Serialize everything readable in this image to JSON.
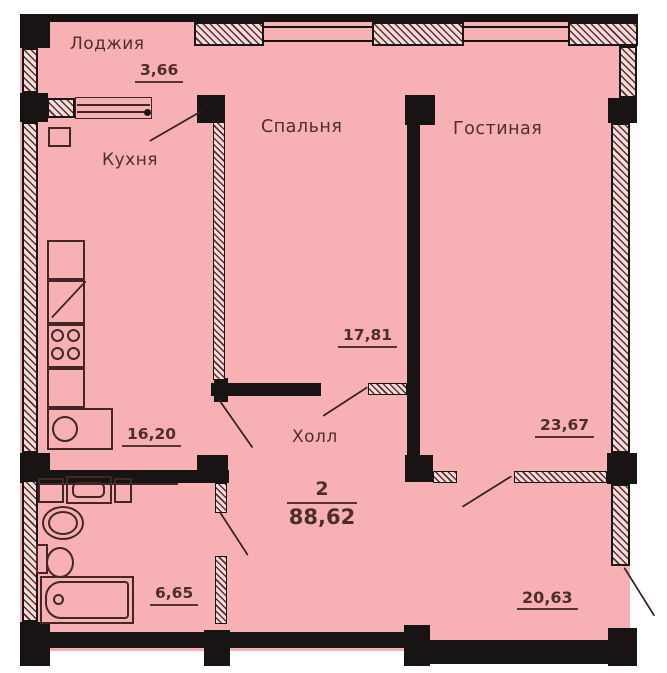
{
  "plan": {
    "summary": {
      "rooms_count": "2",
      "total_area": "88,62"
    },
    "rooms": [
      {
        "name": "Лоджия",
        "area": "3,66"
      },
      {
        "name": "Кухня",
        "area": "16,20"
      },
      {
        "name": "Спальня",
        "area": "17,81"
      },
      {
        "name": "Гостиная",
        "area": "23,67"
      },
      {
        "name": "Холл",
        "area": "20,63"
      },
      {
        "name": "",
        "area": "6,65"
      }
    ],
    "colors": {
      "room_fill": "#f7b1b4",
      "wall": "#181414",
      "hatch_line": "#573030",
      "text": "#502d2d"
    }
  }
}
